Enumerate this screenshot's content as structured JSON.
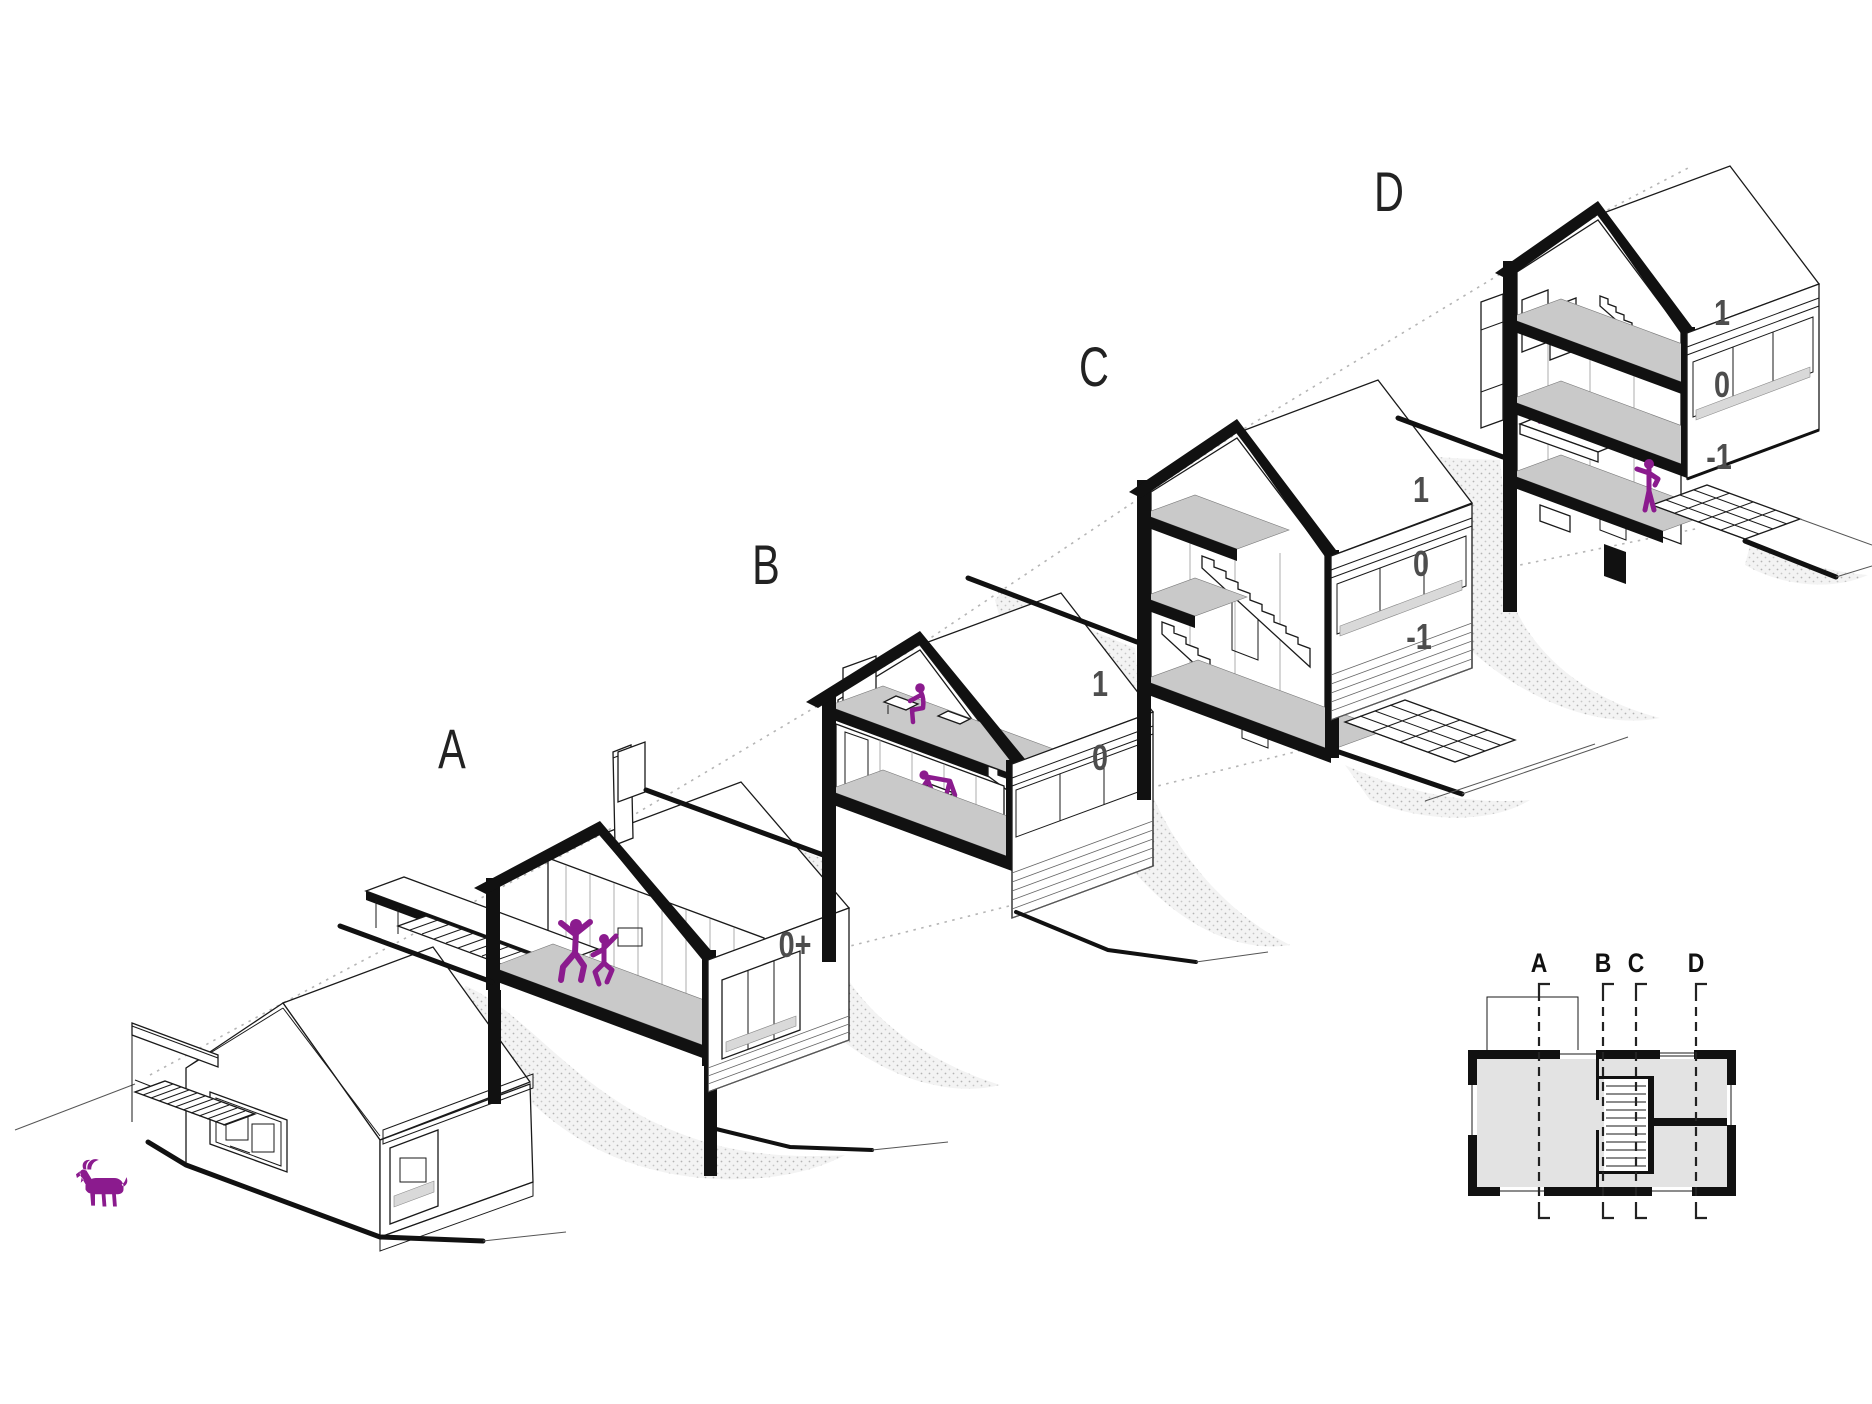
{
  "figure_color": "#8b1b8e",
  "line_color": "#111111",
  "sections": [
    {
      "id": "overview-house",
      "label": "",
      "level_labels": [],
      "figures": [
        "goat-icon"
      ]
    },
    {
      "id": "section-a",
      "label": "A",
      "level_labels": [
        "0+"
      ],
      "figures": [
        "dancing-people-icon"
      ]
    },
    {
      "id": "section-b",
      "label": "B",
      "level_labels": [
        "1",
        "0"
      ],
      "figures": [
        "person-at-desk-icon",
        "person-bending-icon"
      ]
    },
    {
      "id": "section-c",
      "label": "C",
      "level_labels": [
        "1",
        "0",
        "-1"
      ],
      "figures": []
    },
    {
      "id": "section-d",
      "label": "D",
      "level_labels": [
        "1",
        "0",
        "-1"
      ],
      "figures": [
        "cat-icon",
        "person-lying-icon",
        "person-standing-icon"
      ]
    }
  ],
  "plan": {
    "section_marks": [
      "A",
      "B",
      "C",
      "D"
    ]
  }
}
